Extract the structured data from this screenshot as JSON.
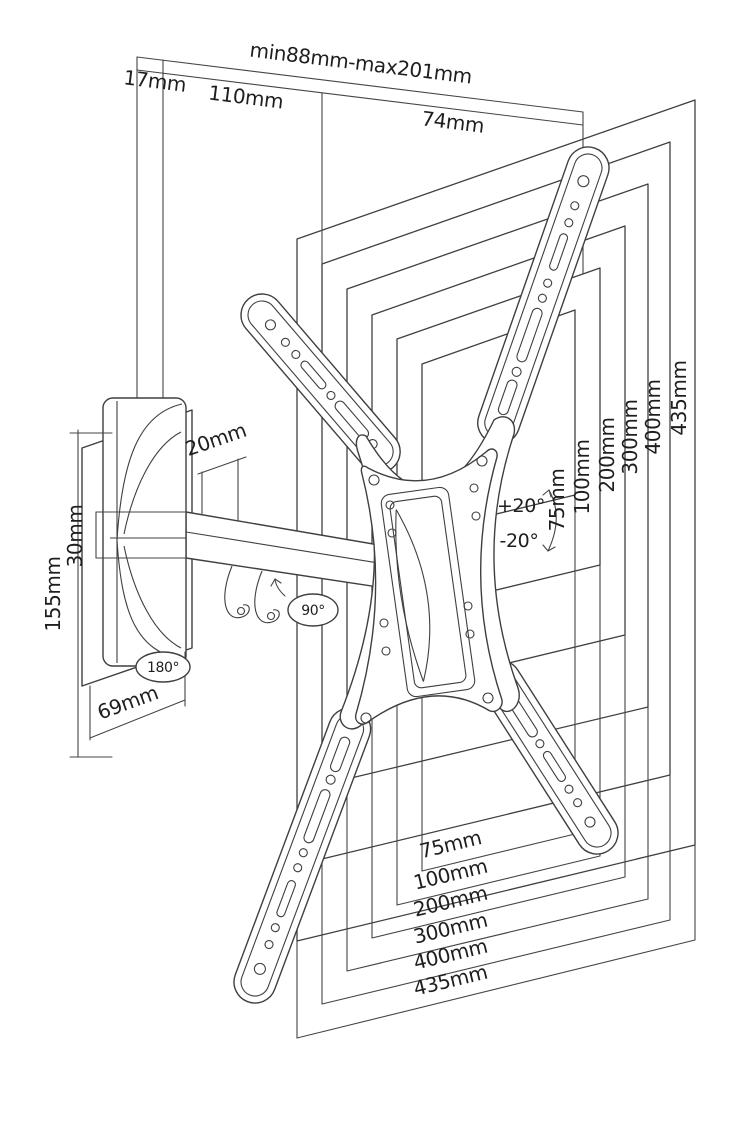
{
  "diagram": {
    "top": {
      "wall_offset": "17mm",
      "plate_depth": "110mm",
      "extension_range": "min88mm-max201mm",
      "bracket_depth": "74mm"
    },
    "left": {
      "plate_height": "155mm",
      "arm_bar_height": "30mm",
      "arm_thickness": "20mm",
      "plate_width": "69mm"
    },
    "angles": {
      "swivel": "180°",
      "pivot": "90°",
      "tilt_up": "+20°",
      "tilt_down": "-20°"
    },
    "vesa_vertical": [
      "75mm",
      "100mm",
      "200mm",
      "300mm",
      "400mm",
      "435mm"
    ],
    "vesa_horizontal": [
      "75mm",
      "100mm",
      "200mm",
      "300mm",
      "400mm",
      "435mm"
    ]
  }
}
